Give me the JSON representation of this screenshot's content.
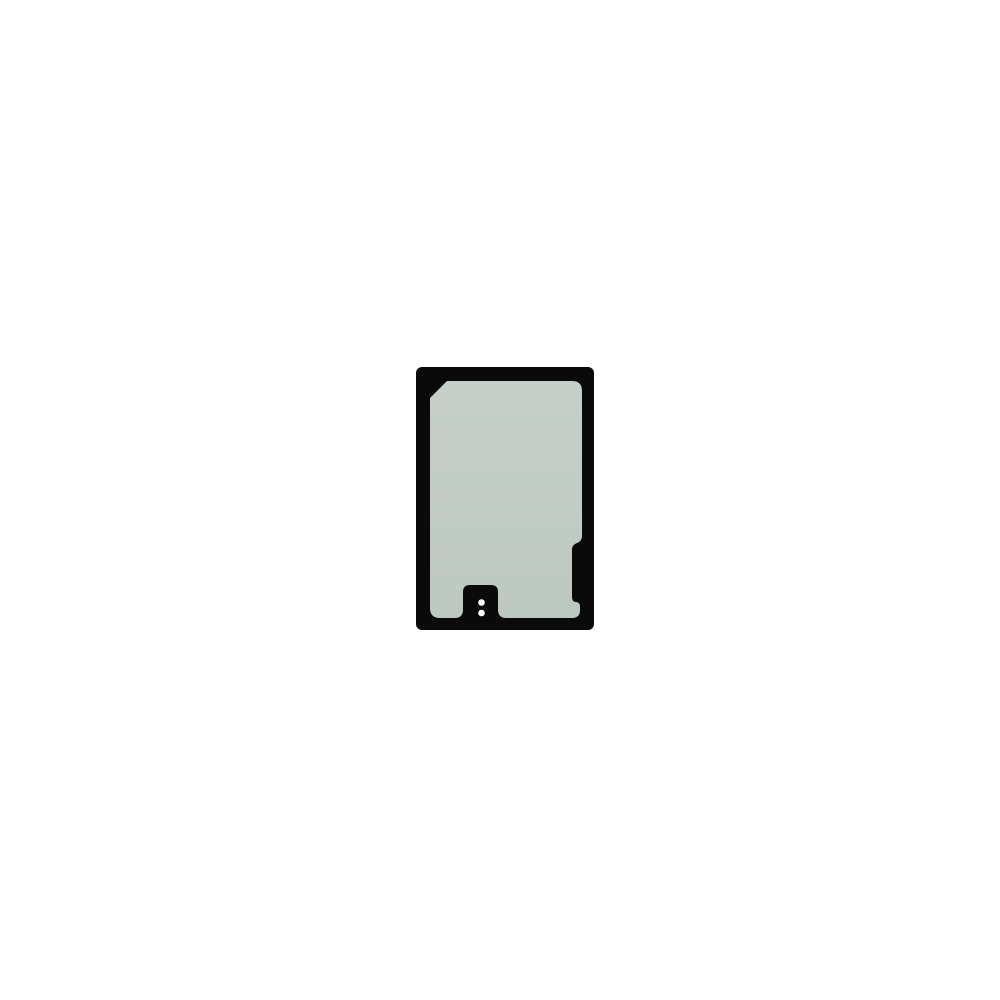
{
  "page": {
    "background_color": "#ffffff"
  },
  "product": {
    "subject": "phone rear-cover adhesive gasket sticker, black frame with pale sage liner, bottom alignment tab with two punched holes and stepped notch on right edge",
    "colors": {
      "frame": "#0a0a0a",
      "liner_top": "#c6cfc9",
      "liner_bottom": "#bdc8c1",
      "dots": "#ffffff",
      "background": "#ffffff"
    }
  }
}
